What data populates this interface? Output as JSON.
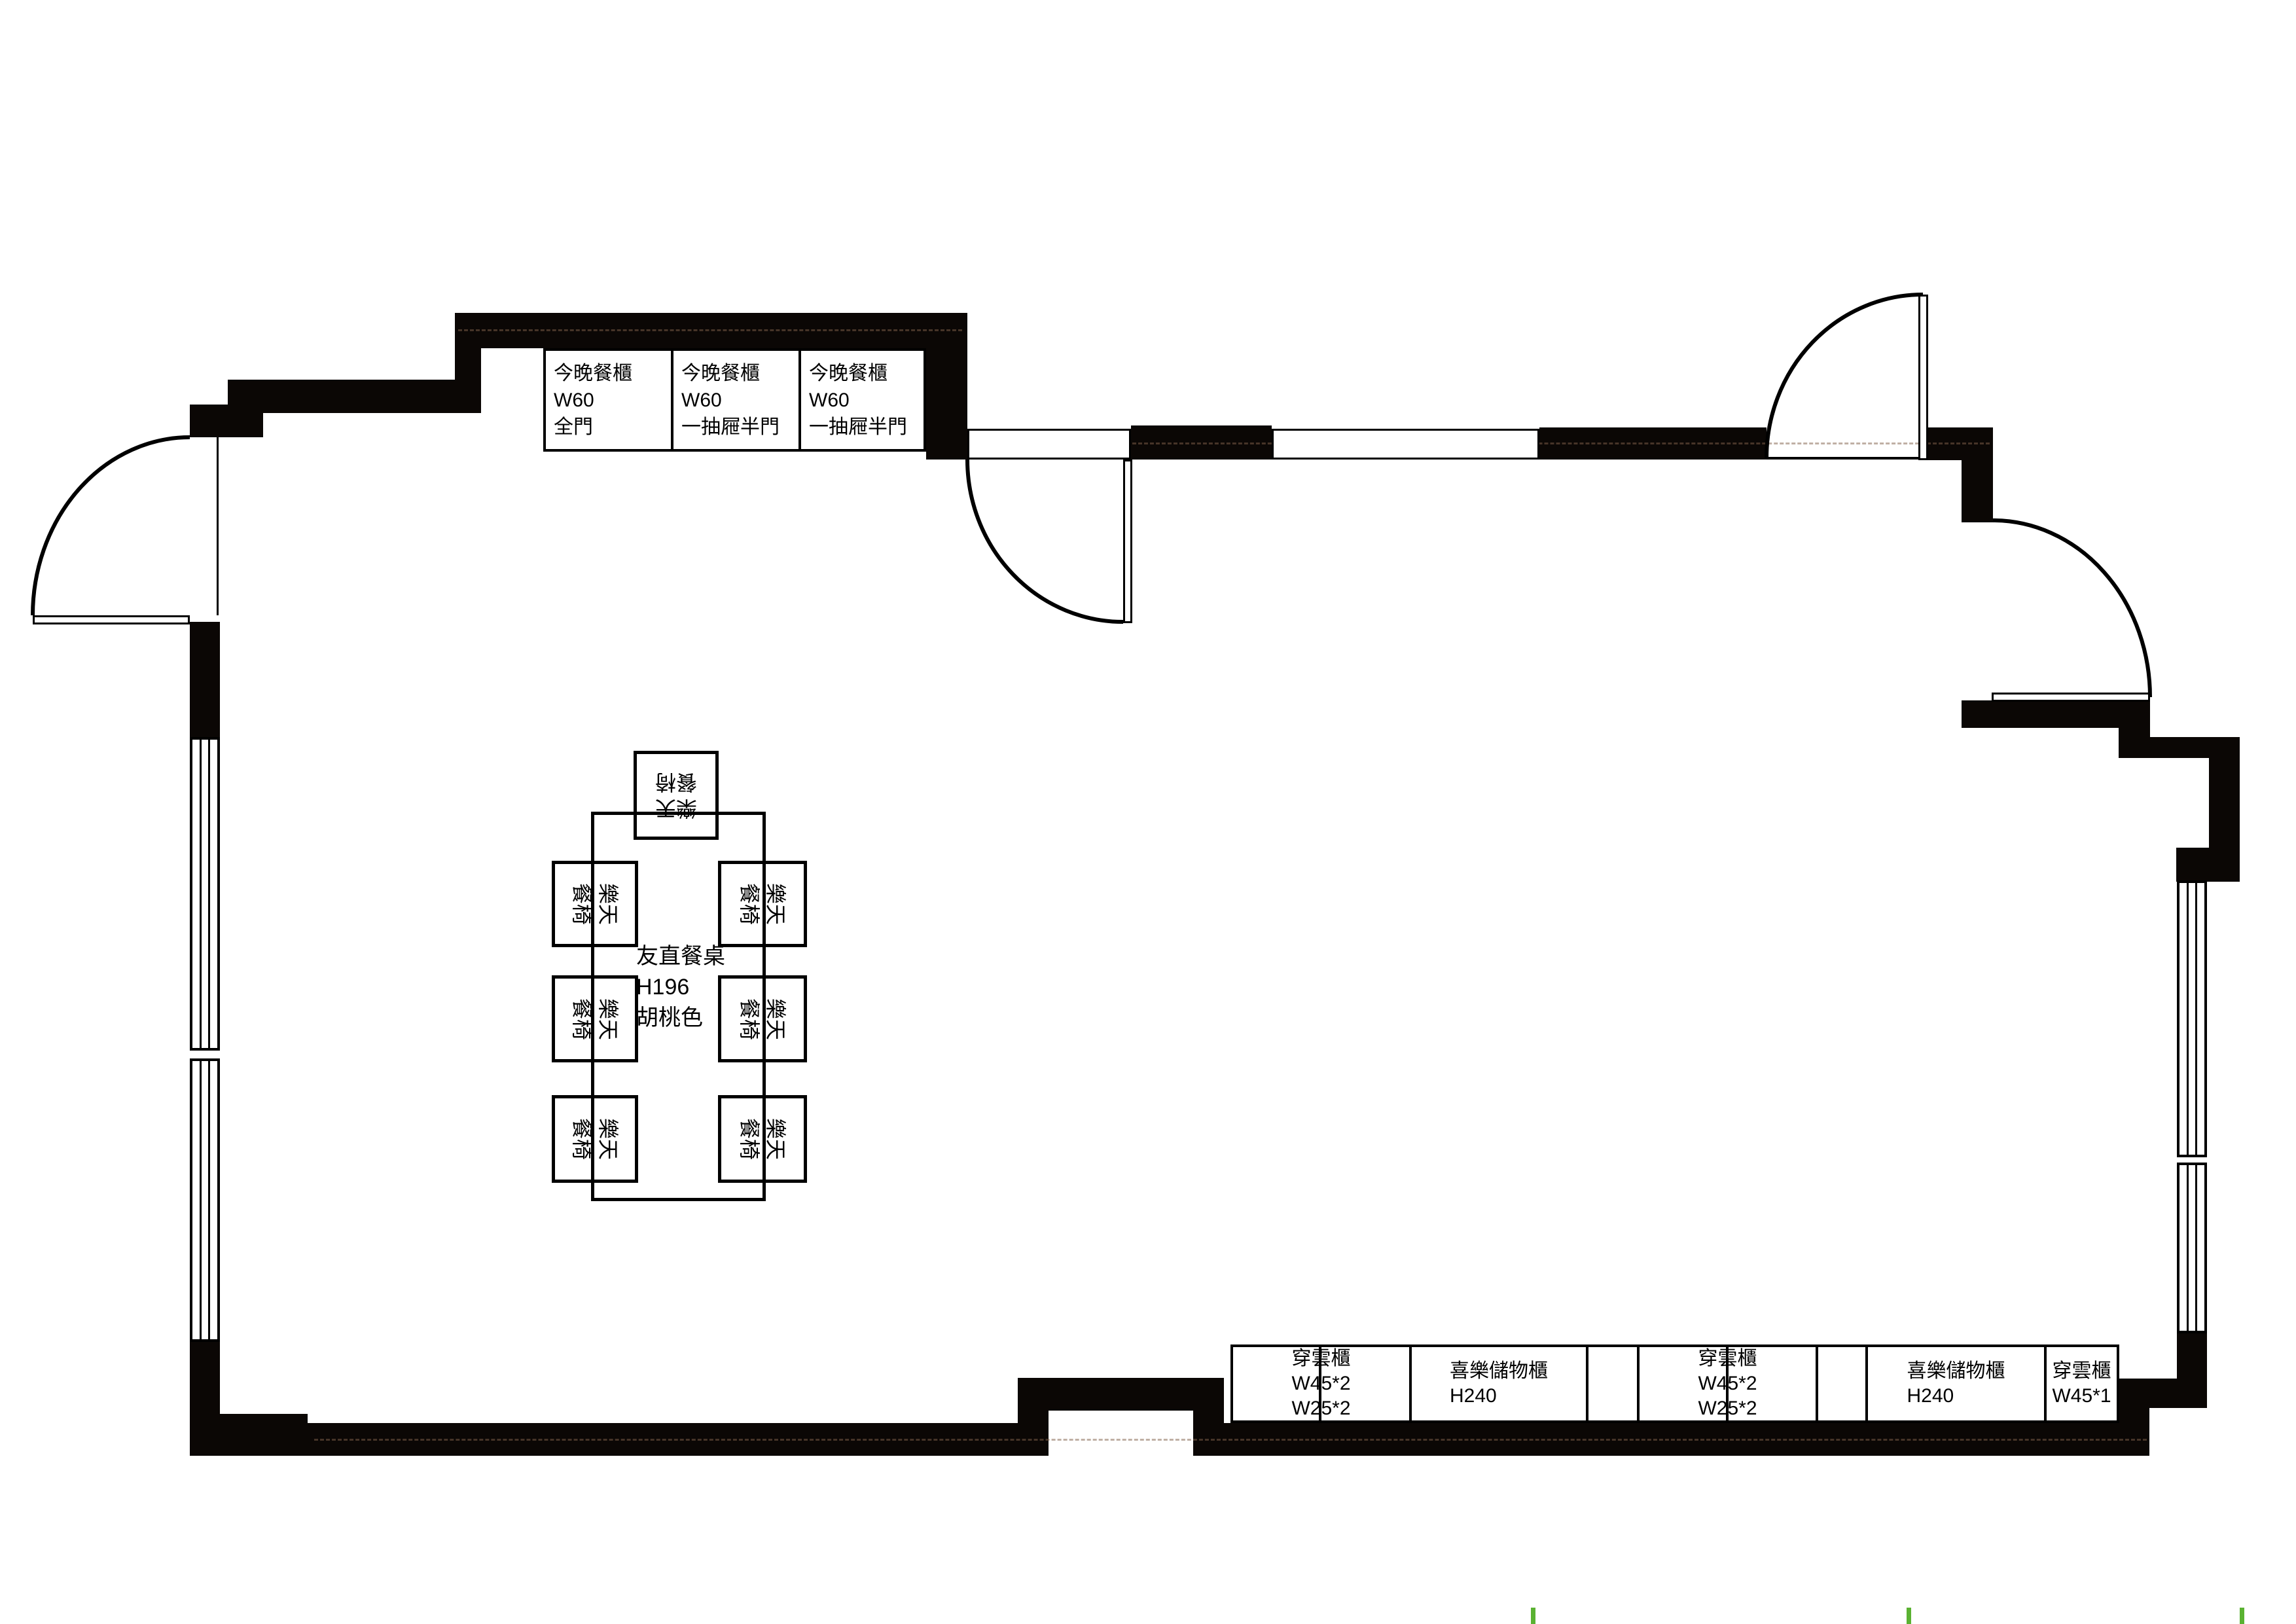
{
  "plan": {
    "colors": {
      "wall": "#0b0705",
      "line": "#000000",
      "tick": "#5ab232"
    },
    "top_cabinets": [
      {
        "label": "今晚餐櫃\nW60\n全門"
      },
      {
        "label": "今晚餐櫃\nW60\n一抽屜半門"
      },
      {
        "label": "今晚餐櫃\nW60\n一抽屜半門"
      }
    ],
    "bottom_cabinets": [
      {
        "label": "穿雲櫃\nW45*2\nW25*2"
      },
      {
        "label": "喜樂儲物櫃\nH240"
      },
      {
        "label": ""
      },
      {
        "label": "穿雲櫃\nW45*2\nW25*2"
      },
      {
        "label": ""
      },
      {
        "label": "喜樂儲物櫃\nH240"
      },
      {
        "label": "穿雲櫃\nW45*1"
      }
    ],
    "dining": {
      "table_label": "友直餐桌\nH196\n胡桃色",
      "chair_label": "樂天\n餐椅"
    }
  }
}
